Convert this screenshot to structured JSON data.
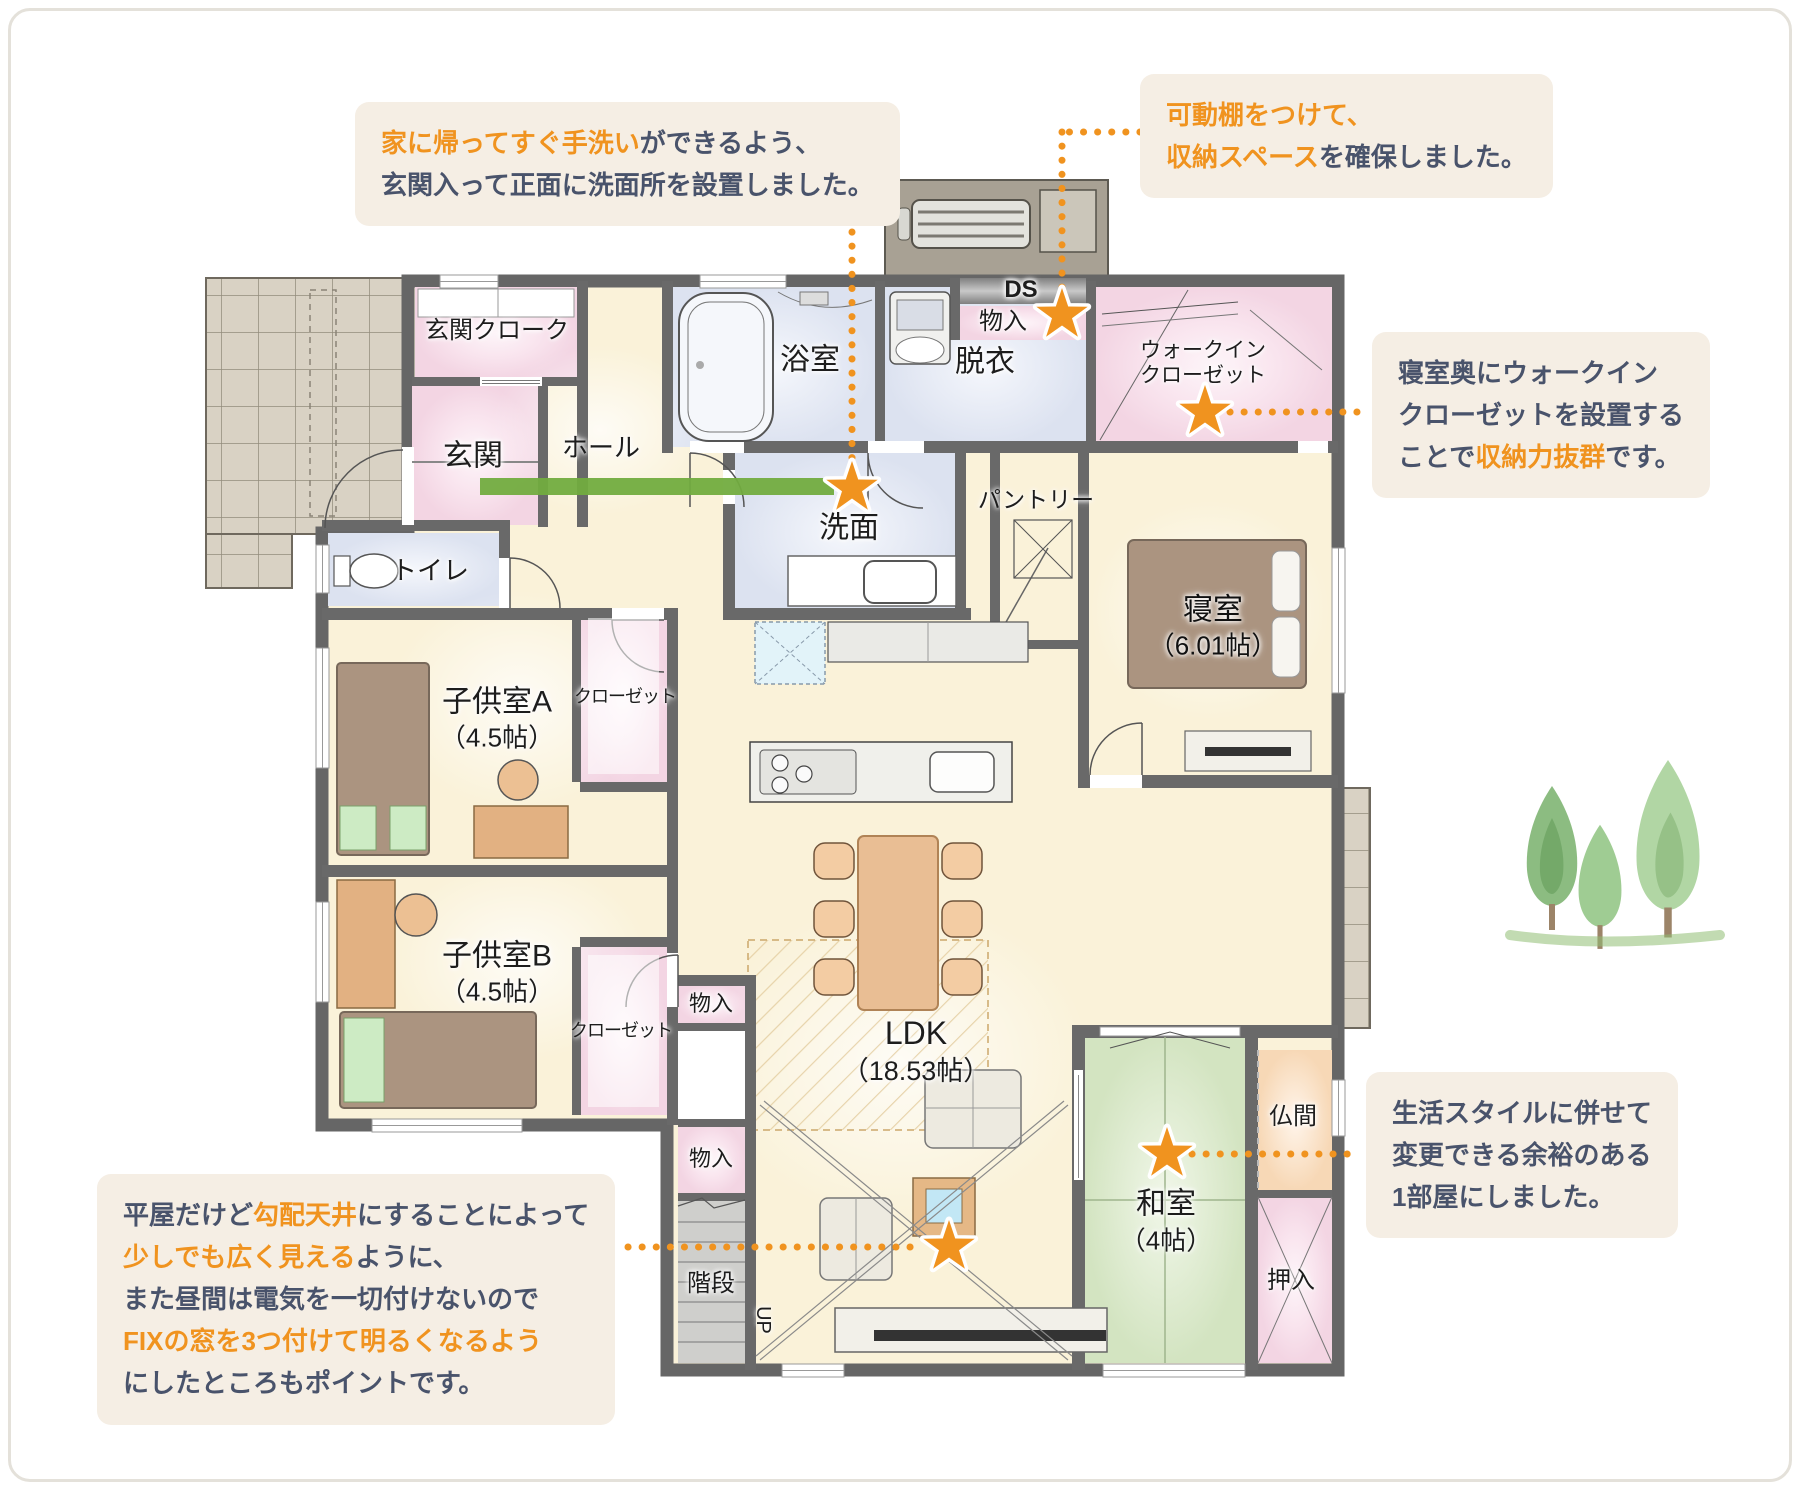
{
  "colors": {
    "accent_orange": "#F0931F",
    "callout_bg": "#F5EEE4",
    "callout_text": "#49536B",
    "entry_arrow_green": "#72AC3F",
    "wall": "#696969",
    "room_cream": "#FAF2D9",
    "room_pink": "#F6D9E7",
    "room_blue": "#DCE2F0",
    "room_green": "#D3E4C1",
    "room_peach": "#F8D9B8",
    "tile": "#D9D2C4"
  },
  "callouts": {
    "wash_entry": {
      "lines": [
        [
          {
            "t": "家に帰ってすぐ手洗い",
            "hl": true
          },
          {
            "t": "ができるよう、",
            "hl": false
          }
        ],
        [
          {
            "t": "玄関入って正面に洗面所を設置しました。",
            "hl": false
          }
        ]
      ]
    },
    "movable_shelf": {
      "lines": [
        [
          {
            "t": "可動棚をつけて、",
            "hl": true
          }
        ],
        [
          {
            "t": "収納スペース",
            "hl": true
          },
          {
            "t": "を確保しました。",
            "hl": false
          }
        ]
      ]
    },
    "wic": {
      "lines": [
        [
          {
            "t": "寝室奥にウォークイン",
            "hl": false
          }
        ],
        [
          {
            "t": "クローゼットを設置する",
            "hl": false
          }
        ],
        [
          {
            "t": "ことで",
            "hl": false
          },
          {
            "t": "収納力抜群",
            "hl": true
          },
          {
            "t": "です。",
            "hl": false
          }
        ]
      ]
    },
    "washitsu_flex": {
      "lines": [
        [
          {
            "t": "生活スタイルに併せて",
            "hl": false
          }
        ],
        [
          {
            "t": "変更できる余裕のある",
            "hl": false
          }
        ],
        [
          {
            "t": "1部屋にしました。",
            "hl": false
          }
        ]
      ]
    },
    "ceiling": {
      "lines": [
        [
          {
            "t": "平屋だけど",
            "hl": false
          },
          {
            "t": "勾配天井",
            "hl": true
          },
          {
            "t": "にすることによって",
            "hl": false
          }
        ],
        [
          {
            "t": "少しでも広く見える",
            "hl": true
          },
          {
            "t": "ように、",
            "hl": false
          }
        ],
        [
          {
            "t": "また昼間は電気を一切付けないので",
            "hl": false
          }
        ],
        [
          {
            "t": "FIXの窓を3つ付けて明るくなるよう",
            "hl": true
          }
        ],
        [
          {
            "t": "にしたところもポイントです。",
            "hl": false
          }
        ]
      ]
    }
  },
  "rooms": {
    "genkan_cloak": "玄関クローク",
    "genkan": "玄関",
    "hall": "ホール",
    "toilet": "トイレ",
    "bath": "浴室",
    "datsui": "脱衣",
    "ds": "DS",
    "mono_top": "物入",
    "wic_1": "ウォークイン",
    "wic_2": "クローゼット",
    "senmen": "洗面",
    "pantry": "パントリー",
    "bedroom": "寝室",
    "bedroom_size": "（6.01帖）",
    "kids_a": "子供室A",
    "kids_a_size": "（4.5帖）",
    "closet_a": "クローゼット",
    "kids_b": "子供室B",
    "kids_b_size": "（4.5帖）",
    "closet_b": "クローゼット",
    "mono_mid": "物入",
    "mono_low": "物入",
    "stairs": "階段",
    "up": "UP",
    "ldk": "LDK",
    "ldk_size": "（18.53帖）",
    "washitsu": "和室",
    "washitsu_size": "（4帖）",
    "butsuma": "仏間",
    "oshiire": "押入"
  }
}
